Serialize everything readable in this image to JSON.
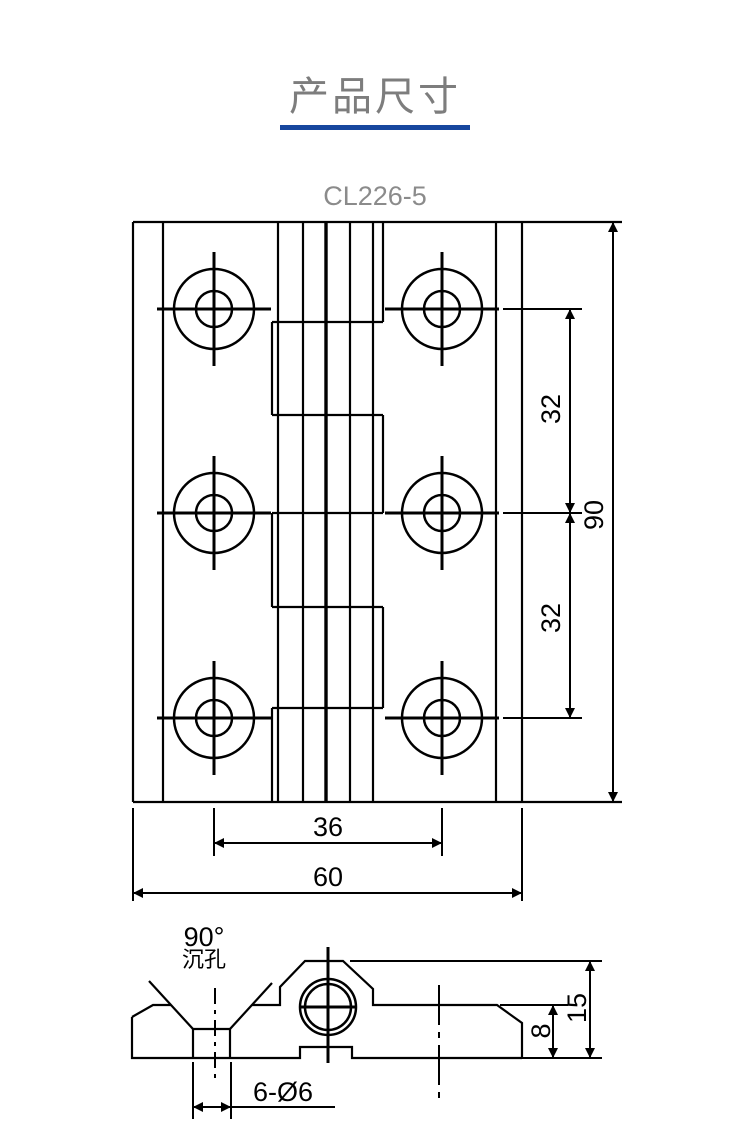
{
  "page": {
    "title": "产品尺寸",
    "accent_color": "#17479e"
  },
  "drawing": {
    "model": "CL226-5",
    "front": {
      "dim_pitch_top": "32",
      "dim_pitch_bottom": "32",
      "dim_height": "90",
      "dim_hole_span": "36",
      "dim_width": "60"
    },
    "side": {
      "countersink_angle": "90°",
      "countersink_label": "沉孔",
      "holes_label": "6-Ø6",
      "dim_plate_thickness": "8",
      "dim_total_height": "15"
    }
  }
}
